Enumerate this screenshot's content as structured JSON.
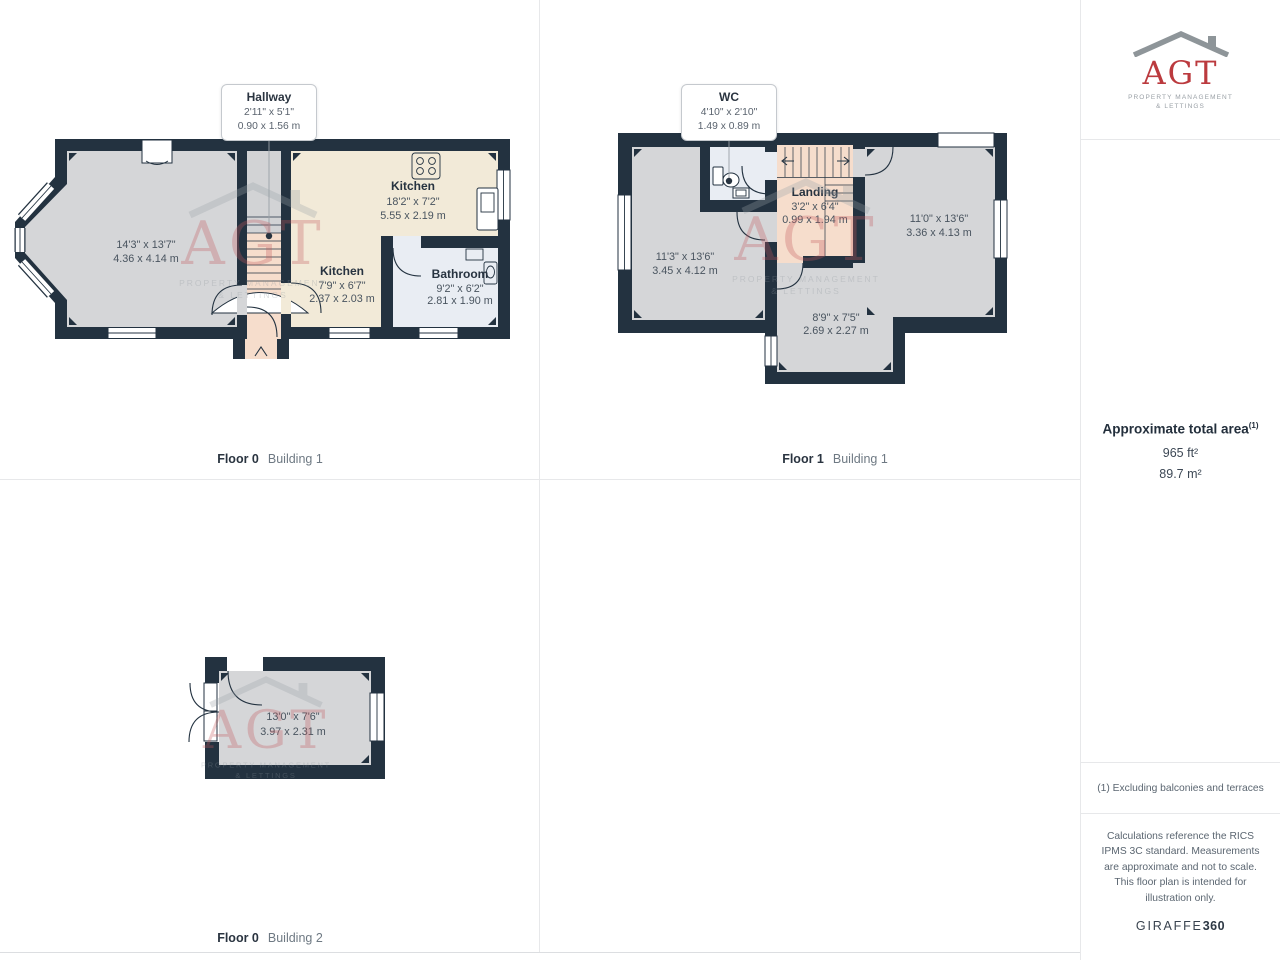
{
  "colors": {
    "wall": "#233240",
    "room_fill": "#d5d6d8",
    "kitchen_fill": "#f2ead8",
    "hall_fill": "#f6ddcc",
    "wet_room_fill": "#e9edf3",
    "brand_red": "#bb3a3e"
  },
  "watermark": {
    "text": "AGT",
    "line1": "PROPERTY MANAGEMENT",
    "line2": "& LETTINGS"
  },
  "floor0_b1": {
    "caption": {
      "floor": "Floor 0",
      "building": "Building 1"
    },
    "callout": {
      "name": "Hallway",
      "imperial": "2'11\" x 5'1\"",
      "metric": "0.90 x 1.56 m"
    },
    "rooms": {
      "living": {
        "imperial": "14'3\" x 13'7\"",
        "metric": "4.36 x 4.14 m"
      },
      "kitchen_main": {
        "name": "Kitchen",
        "imperial": "18'2\" x 7'2\"",
        "metric": "5.55 x 2.19 m"
      },
      "kitchen_small": {
        "name": "Kitchen",
        "imperial": "7'9\" x 6'7\"",
        "metric": "2.37 x 2.03 m"
      },
      "bathroom": {
        "name": "Bathroom",
        "imperial": "9'2\" x 6'2\"",
        "metric": "2.81 x 1.90 m"
      }
    }
  },
  "floor1_b1": {
    "caption": {
      "floor": "Floor 1",
      "building": "Building 1"
    },
    "callout": {
      "name": "WC",
      "imperial": "4'10\" x 2'10\"",
      "metric": "1.49 x 0.89 m"
    },
    "rooms": {
      "bedroom_left": {
        "imperial": "11'3\" x 13'6\"",
        "metric": "3.45 x 4.12 m"
      },
      "landing": {
        "name": "Landing",
        "imperial": "3'2\" x 6'4\"",
        "metric": "0.99 x 1.94 m"
      },
      "bedroom_right": {
        "imperial": "11'0\" x 13'6\"",
        "metric": "3.36 x 4.13 m"
      },
      "room_small": {
        "imperial": "8'9\" x 7'5\"",
        "metric": "2.69 x 2.27 m"
      }
    }
  },
  "floor0_b2": {
    "caption": {
      "floor": "Floor 0",
      "building": "Building 2"
    },
    "rooms": {
      "garage": {
        "imperial": "13'0\" x 7'6\"",
        "metric": "3.97 x 2.31 m"
      }
    }
  },
  "sidebar": {
    "logo": {
      "text": "AGT",
      "line1": "PROPERTY MANAGEMENT",
      "line2": "& LETTINGS"
    },
    "area": {
      "title": "Approximate total area",
      "footnote_marker": "(1)",
      "imperial": "965 ft²",
      "metric": "89.7 m²"
    },
    "footnote": "(1) Excluding balconies and terraces",
    "disclaimer": "Calculations reference the RICS IPMS 3C standard. Measurements are approximate and not to scale. This floor plan is intended for illustration only.",
    "brand": {
      "name": "GIRAFFE",
      "suffix": "360"
    }
  }
}
